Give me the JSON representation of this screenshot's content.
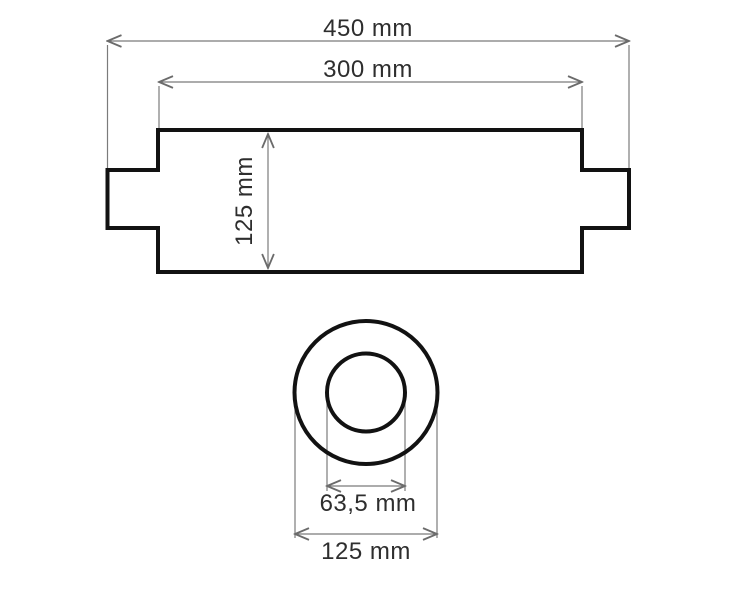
{
  "drawing": {
    "colors": {
      "outline": "#121212",
      "dimension_lines": "#7b7b7b",
      "label_text": "#2e2e2e",
      "background": "#ffffff"
    },
    "side_view": {
      "overall_length_label": "450 mm",
      "body_length_label": "300 mm",
      "body_height_label": "125 mm"
    },
    "end_view": {
      "inner_diameter_label": "63,5 mm",
      "outer_diameter_label": "125 mm"
    }
  }
}
